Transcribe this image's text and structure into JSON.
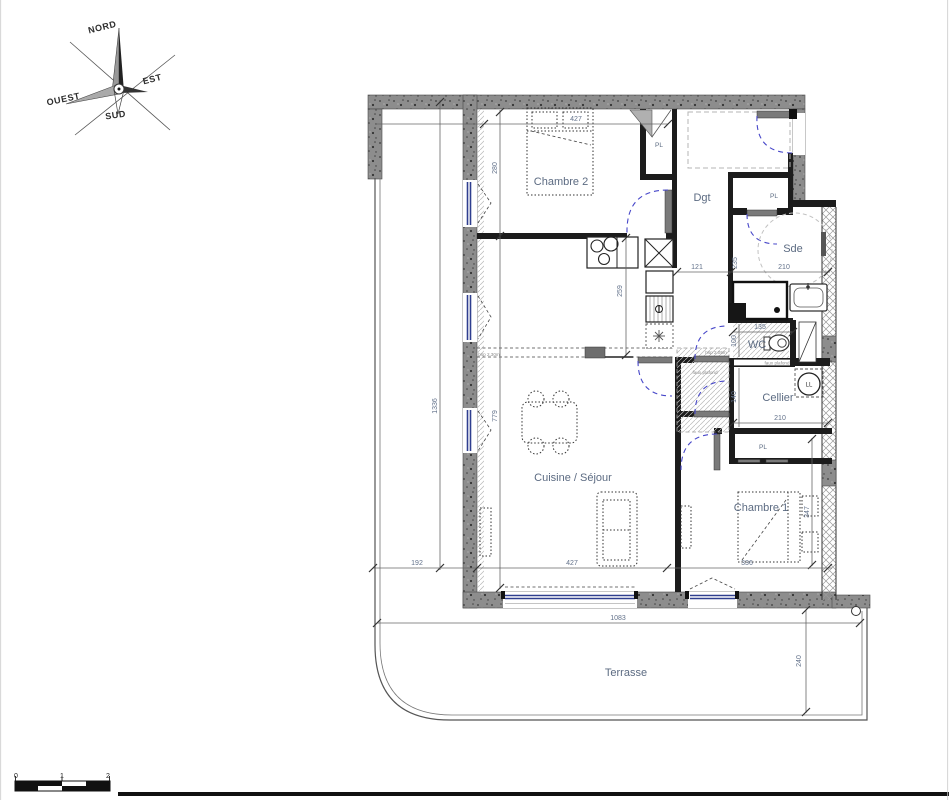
{
  "compass": {
    "north": "NORD",
    "east": "EST",
    "south": "SUD",
    "west": "OUEST"
  },
  "rooms": {
    "chambre2": "Chambre 2",
    "dgt": "Dgt",
    "sde": "Sde",
    "wc": "WC",
    "cellier": "Cellier",
    "chambre1": "Chambre 1",
    "cuisine_sejour": "Cuisine / Séjour",
    "terrasse": "Terrasse"
  },
  "closets": {
    "chambre2_pl": "PL",
    "entry_pl": "PL",
    "chambre1_pl": "PL"
  },
  "appliances": {
    "lave_linge": "LL"
  },
  "dims": {
    "d427_top": "427",
    "d280": "280",
    "d1336": "1336",
    "d259": "259",
    "d779": "779",
    "d121": "121",
    "d235": "235",
    "d210_sde": "210",
    "d135": "135",
    "d100": "100",
    "d140": "140",
    "d210_cellier": "210",
    "d347": "347",
    "d336": "336",
    "d192": "192",
    "d427_bottom": "427",
    "d1083": "1083",
    "d240": "240"
  },
  "notes": {
    "hsp_sejour": "hsp 2.30m",
    "hsp_wc": "hsp 2.05m",
    "faux_plafond_wc": "faux plafond",
    "faux_plafond_hall": "faux plafond"
  },
  "scale_bar": {
    "zero": "0",
    "one": "1",
    "two": "2"
  },
  "colors": {
    "wall_fill": "#8d8d8d",
    "wall_speckle": "#3c3c3c",
    "partition": "#1c1c1c",
    "room_label": "#5c6b82",
    "dimension_text": "#62718a",
    "door_swing": "#4747c9",
    "window_glazing": "#2f3e8f",
    "hatch_line": "#b9b9b9"
  }
}
